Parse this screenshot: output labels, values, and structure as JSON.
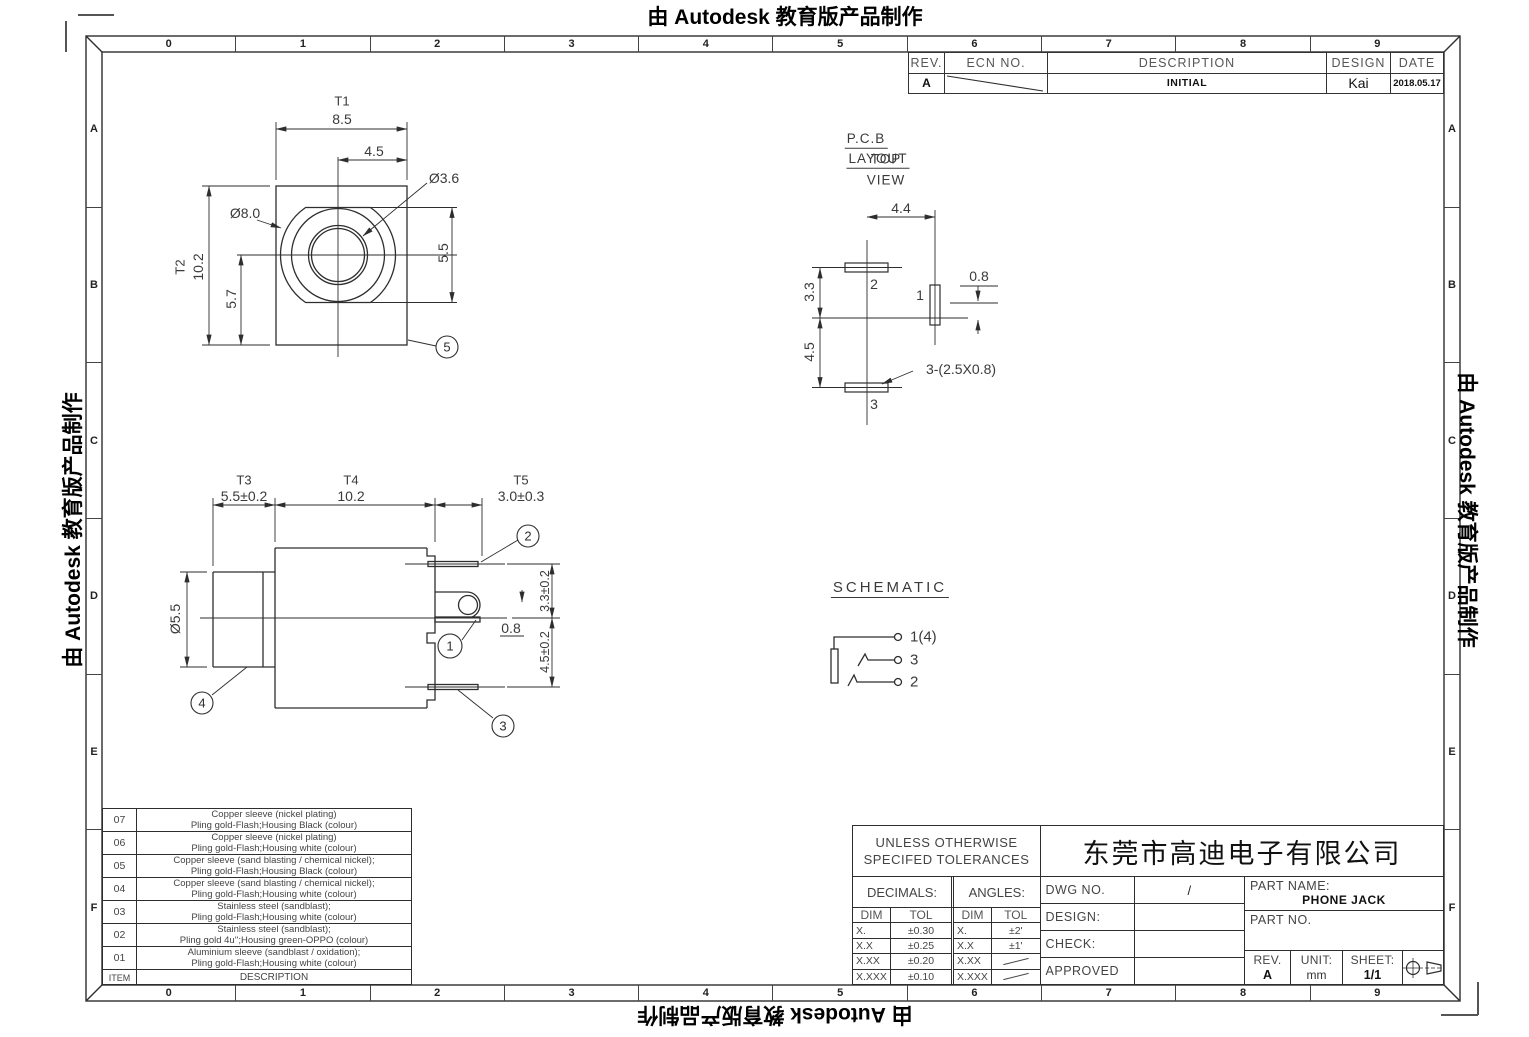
{
  "colors": {
    "background": "#ffffff",
    "line": "#2e2e2e",
    "text": "#3a3a3a",
    "accent_text": "#111111"
  },
  "watermark": {
    "text": "由 Autodesk 教育版产品制作"
  },
  "frame": {
    "columns": [
      "0",
      "1",
      "2",
      "3",
      "4",
      "5",
      "6",
      "7",
      "8",
      "9"
    ],
    "rows": [
      "A",
      "B",
      "C",
      "D",
      "E",
      "F"
    ]
  },
  "revision_table": {
    "headers": {
      "rev": "REV.",
      "ecn": "ECN NO.",
      "description": "DESCRIPTION",
      "design": "DESIGN",
      "date": "DATE"
    },
    "row": {
      "rev": "A",
      "description": "INITIAL",
      "design": "Kai",
      "date": "2018.05.17"
    }
  },
  "front_view": {
    "t1": "T1",
    "t1_val": "8.5",
    "dim_45": "4.5",
    "dia_36": "Ø3.6",
    "dia_80": "Ø8.0",
    "t2": "T2",
    "t2_val": "10.2",
    "dim_57": "5.7",
    "dim_55": "5.5",
    "balloon5": "5"
  },
  "pcb_view": {
    "title_line1": "P.C.B",
    "title_line2": "LAYOUT",
    "title_overlay": "TOP",
    "title_line3": "VIEW",
    "dim_44": "4.4",
    "dim_08": "0.8",
    "dim_33": "3.3",
    "dim_45": "4.5",
    "pad_note": "3-(2.5X0.8)",
    "pin1": "1",
    "pin2": "2",
    "pin3": "3"
  },
  "side_view": {
    "t3": "T3",
    "t3_val": "5.5±0.2",
    "t4": "T4",
    "t4_val": "10.2",
    "t5": "T5",
    "t5_val": "3.0±0.3",
    "dia_55": "Ø5.5",
    "dim_08": "0.8",
    "dim_33": "3.3±0.2",
    "dim_45": "4.5±0.2",
    "balloon1": "1",
    "balloon2": "2",
    "balloon3": "3",
    "balloon4": "4"
  },
  "schematic": {
    "title": "SCHEMATIC",
    "pin1": "1(4)",
    "pin3": "3",
    "pin2": "2"
  },
  "materials_table": {
    "header": {
      "item": "ITEM",
      "description": "DESCRIPTION"
    },
    "rows": [
      {
        "item": "07",
        "line1": "Copper sleeve (nickel plating)",
        "line2": "Pling gold-Flash;Housing Black (colour)"
      },
      {
        "item": "06",
        "line1": "Copper sleeve (nickel plating)",
        "line2": "Pling gold-Flash;Housing white (colour)"
      },
      {
        "item": "05",
        "line1": "Copper sleeve (sand blasting / chemical nickel);",
        "line2": "Pling gold-Flash;Housing Black (colour)"
      },
      {
        "item": "04",
        "line1": "Copper sleeve (sand blasting / chemical nickel);",
        "line2": "Pling gold-Flash;Housing white (colour)"
      },
      {
        "item": "03",
        "line1": "Stainless steel (sandblast);",
        "line2": "Pling gold-Flash;Housing white (colour)"
      },
      {
        "item": "02",
        "line1": "Stainless steel (sandblast);",
        "line2": "Pling gold 4u'';Housing green-OPPO (colour)"
      },
      {
        "item": "01",
        "line1": "Aluminium sleeve (sandblast / oxidation);",
        "line2": "Pling gold-Flash;Housing white (colour)"
      }
    ]
  },
  "title_block": {
    "tolerance_note_line1": "UNLESS OTHERWISE",
    "tolerance_note_line2": "SPECIFED TOLERANCES",
    "decimals_label": "DECIMALS:",
    "angles_label": "ANGLES:",
    "dim_label": "DIM",
    "tol_label": "TOL",
    "decimals_rows": [
      {
        "dim": "X.",
        "tol": "±0.30"
      },
      {
        "dim": "X.X",
        "tol": "±0.25"
      },
      {
        "dim": "X.XX",
        "tol": "±0.20"
      },
      {
        "dim": "X.XXX",
        "tol": "±0.10"
      }
    ],
    "angles_rows": [
      {
        "dim": "X.",
        "tol": "±2'"
      },
      {
        "dim": "X.X",
        "tol": "±1'"
      },
      {
        "dim": "X.XX",
        "tol": ""
      },
      {
        "dim": "X.XXX",
        "tol": ""
      }
    ],
    "dwg_no_label": "DWG NO.",
    "dwg_no_value": "/",
    "design_label": "DESIGN:",
    "check_label": "CHECK:",
    "approved_label": "APPROVED",
    "company": "东莞市高迪电子有限公司",
    "part_name_label": "PART NAME:",
    "part_name": "PHONE JACK",
    "part_no_label": "PART NO.",
    "rev_label": "REV.",
    "rev": "A",
    "unit_label": "UNIT:",
    "unit": "mm",
    "sheet_label": "SHEET:",
    "sheet": "1/1"
  }
}
